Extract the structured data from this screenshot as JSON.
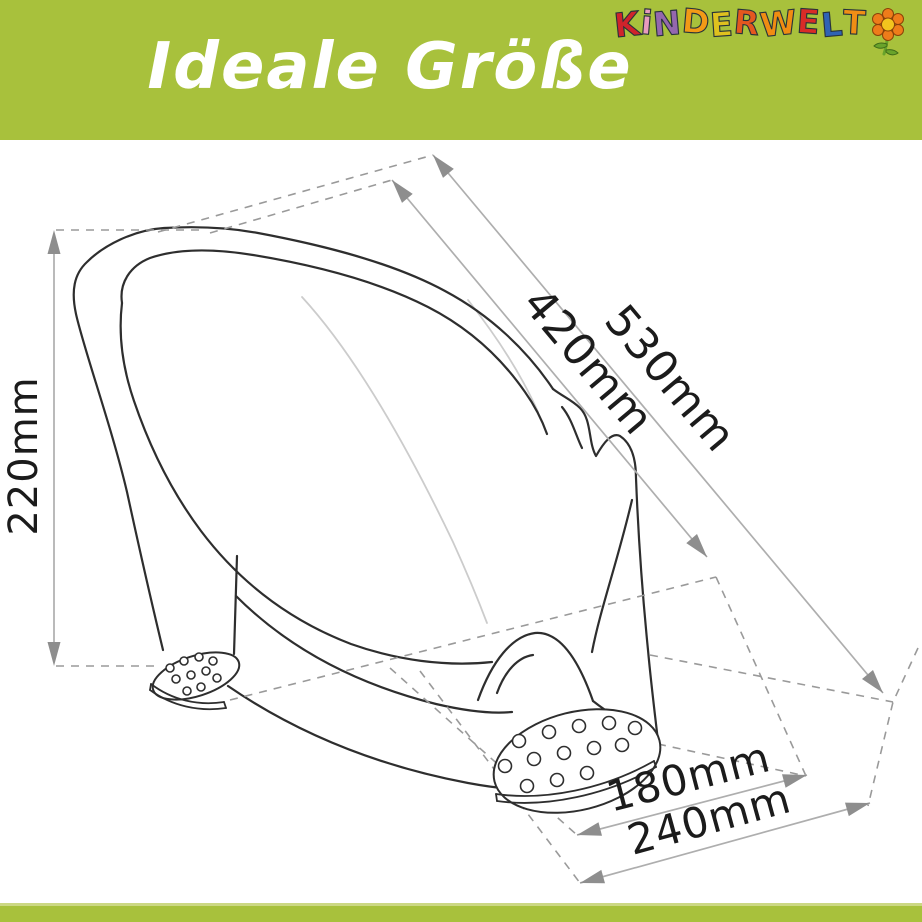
{
  "header": {
    "title": "Ideale Größe",
    "bg_color": "#a8c13c",
    "text_color": "#ffffff"
  },
  "logo": {
    "name": "KINDERWELT",
    "letters": [
      {
        "ch": "K",
        "color": "#d0232b",
        "rot": -6,
        "dy": 2
      },
      {
        "ch": "i",
        "color": "#e89bbd",
        "rot": 5,
        "dy": 0
      },
      {
        "ch": "N",
        "color": "#9467ae",
        "rot": -5,
        "dy": 1
      },
      {
        "ch": "D",
        "color": "#f29a16",
        "rot": 5,
        "dy": -1
      },
      {
        "ch": "E",
        "color": "#dfc11e",
        "rot": -4,
        "dy": 2
      },
      {
        "ch": "R",
        "color": "#e4571f",
        "rot": 5,
        "dy": 0
      },
      {
        "ch": "W",
        "color": "#f08c12",
        "rot": -6,
        "dy": 1
      },
      {
        "ch": "E",
        "color": "#d92b27",
        "rot": 4,
        "dy": -1
      },
      {
        "ch": "L",
        "color": "#2f63b5",
        "rot": -5,
        "dy": 2
      },
      {
        "ch": "T",
        "color": "#ef8e15",
        "rot": 3,
        "dy": 0
      }
    ],
    "flower": {
      "petal": "#ee7c1a",
      "center": "#f2c41e",
      "stem": "#69a32b"
    }
  },
  "diagram": {
    "description": "Technical line drawing of a baby bath seat with dimension arrows",
    "line_color": "#2e2e2e",
    "dim_line_color": "#aeaeae",
    "dash_color": "#9a9a9a",
    "label_color": "#1b1b1b",
    "dimensions": {
      "height": "220mm",
      "inner_length": "420mm",
      "total_length": "530mm",
      "front_width": "180mm",
      "base_width": "240mm"
    }
  },
  "footer": {
    "bg_color": "#a8c13c"
  }
}
